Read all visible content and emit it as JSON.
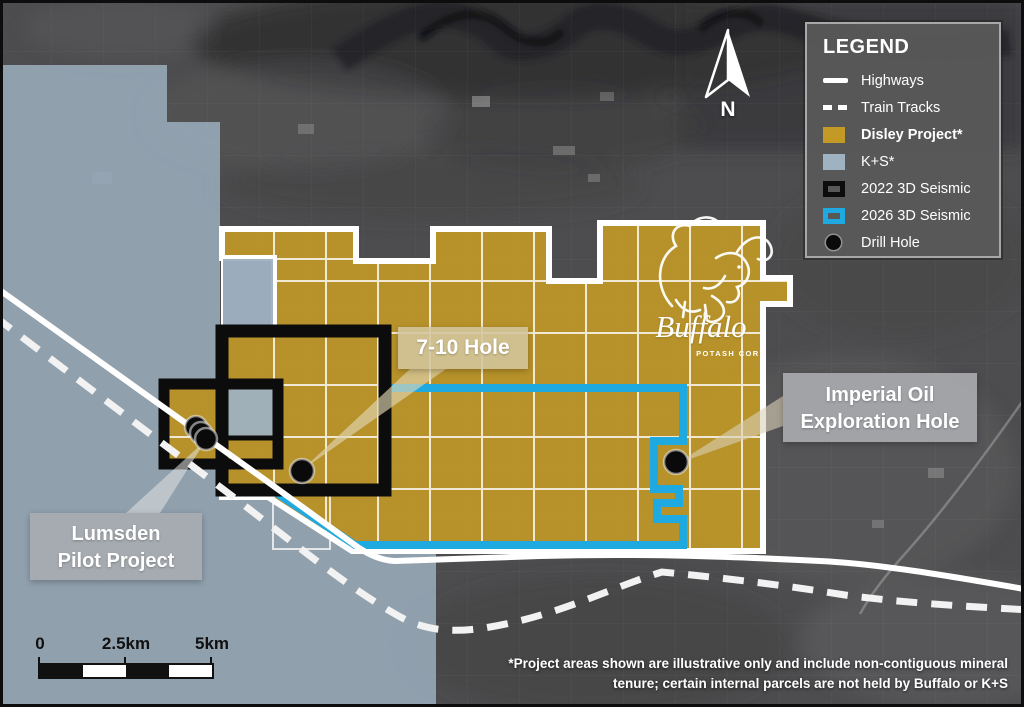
{
  "map": {
    "callouts": {
      "hole_7_10": {
        "label": "7-10 Hole"
      },
      "imperial": {
        "line1": "Imperial Oil",
        "line2": "Exploration Hole"
      },
      "lumsden": {
        "line1": "Lumsden",
        "line2": "Pilot Project"
      }
    },
    "compass": {
      "label": "N"
    },
    "logo": {
      "name": "Buffalo",
      "subtitle": "POTASH CORP"
    }
  },
  "legend": {
    "title": "LEGEND",
    "items": [
      {
        "label": "Highways",
        "swatch": "solid-line"
      },
      {
        "label": "Train Tracks",
        "swatch": "dashed-line"
      },
      {
        "label": "Disley Project*",
        "swatch": "gold-fill"
      },
      {
        "label": "K+S*",
        "swatch": "blue-fill"
      },
      {
        "label": "2022 3D Seismic",
        "swatch": "black-outline"
      },
      {
        "label": "2026 3D Seismic",
        "swatch": "cyan-outline"
      },
      {
        "label": "Drill Hole",
        "swatch": "drill-dot"
      }
    ]
  },
  "scale_bar": {
    "start": "0",
    "mid": "2.5km",
    "end": "5km"
  },
  "footnote": {
    "line1": "*Project areas shown are illustrative only and include non-contiguous mineral",
    "line2": "tenure; certain internal parcels are not held by Buffalo or K+S"
  },
  "colors": {
    "disley_gold": "#C39A26",
    "ks_blue": "#9FB2C2",
    "seismic_2022": "#0C0C0C",
    "seismic_2026": "#1FA9E1",
    "highway_white": "#FFFFFF",
    "legend_bg": "#58585A"
  }
}
